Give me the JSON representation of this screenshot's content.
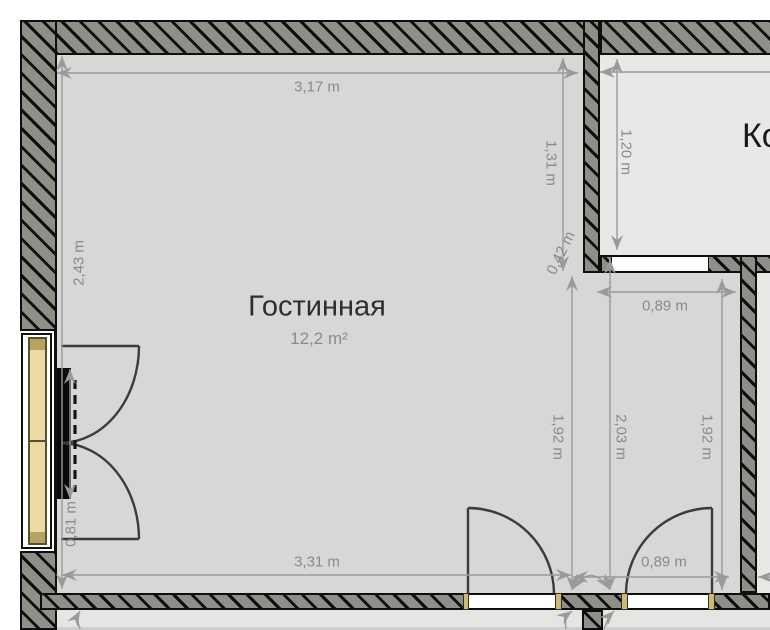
{
  "plan": {
    "rooms": {
      "living": {
        "name": "Гостинная",
        "area": "12,2 m²"
      },
      "adjacent_top_right": {
        "name_partial": "Ко"
      }
    },
    "dimensions": {
      "top_width": "3,17 m",
      "left_height": "2,43 m",
      "right_upper": "1,31 m",
      "kroom_left": "1,20 m",
      "niche": "0,42 m",
      "nook_top_width": "0,89 m",
      "nook_left_height": "1,92 m",
      "nook_mid_height": "2,03 m",
      "nook_right_height": "1,92 m",
      "bottom_width": "3,31 m",
      "bottom_right_width": "0,89 m",
      "window_width": "0,81 m"
    },
    "colors": {
      "wall_fill": "#8f8f87",
      "wall_hatch": "#0e0e0e",
      "floor_living": "#d7d7d5",
      "floor_adjacent": "#e8e8e6",
      "window_wood": "#ecd9a4",
      "door_jamb": "#cdb977",
      "dimension_gray": "#9a9a9a",
      "door_swing": "#3c3c3a",
      "tv_black": "#0a0a0a"
    }
  }
}
